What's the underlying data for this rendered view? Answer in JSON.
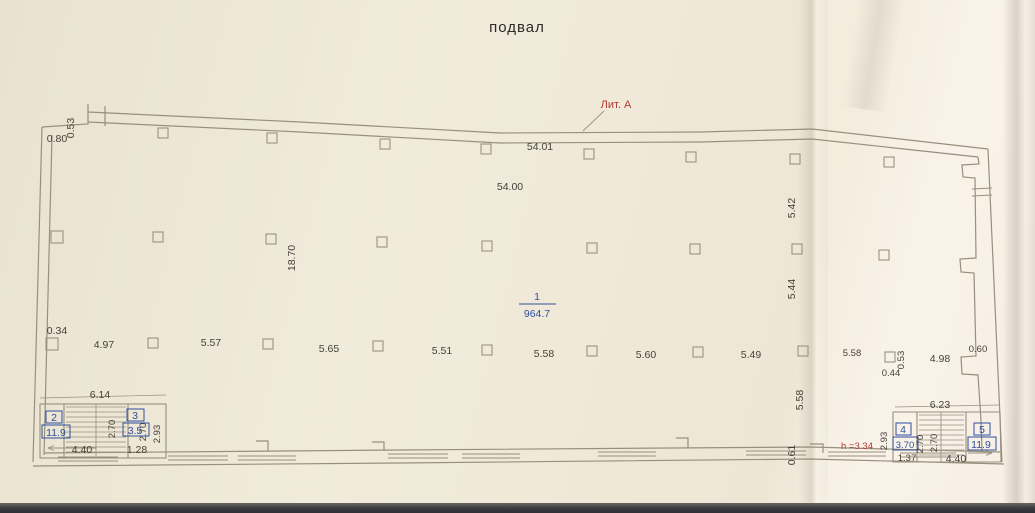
{
  "title": "подвал",
  "litera": "Лит. А",
  "height_note": "h =3.34",
  "rooms": {
    "r1": {
      "num": "1",
      "area": "964.7"
    },
    "r2": {
      "num": "2",
      "area": "11.9"
    },
    "r3": {
      "num": "3",
      "area": "3.5"
    },
    "r4": {
      "num": "4",
      "area": "3.70"
    },
    "r5": {
      "num": "5",
      "area": "11.9"
    }
  },
  "dims": {
    "top_left_w": "0.80",
    "top_left_h": "0.53",
    "top_len_outer": "54.01",
    "top_len_inner": "54.00",
    "mid_height": "18.70",
    "right_v1": "5.42",
    "right_v2": "5.44",
    "right_v3": "5.58",
    "right_v4": "0.61",
    "col_left": "0.34",
    "bay": [
      "4.97",
      "5.57",
      "5.65",
      "5.51",
      "5.58",
      "5.60",
      "5.49",
      "5.58"
    ],
    "right_cluster": {
      "a": "0.44",
      "b": "0.53",
      "c": "4.98",
      "d": "0.60"
    },
    "stair_left": {
      "width": "6.14",
      "h1": "2.70",
      "h2": "2.70",
      "h3": "2.93",
      "w1": "4.40",
      "w2": "1.28"
    },
    "stair_right": {
      "width": "6.23",
      "h1": "2.93",
      "h2": "2.70",
      "h3": "2.70",
      "w1": "1.37",
      "w2": "4.40"
    }
  },
  "colors": {
    "blue": "#2f4f9e",
    "red": "#b03a36",
    "ink": "#46413a",
    "line": "#98927f",
    "paper": "#f0e9db"
  }
}
